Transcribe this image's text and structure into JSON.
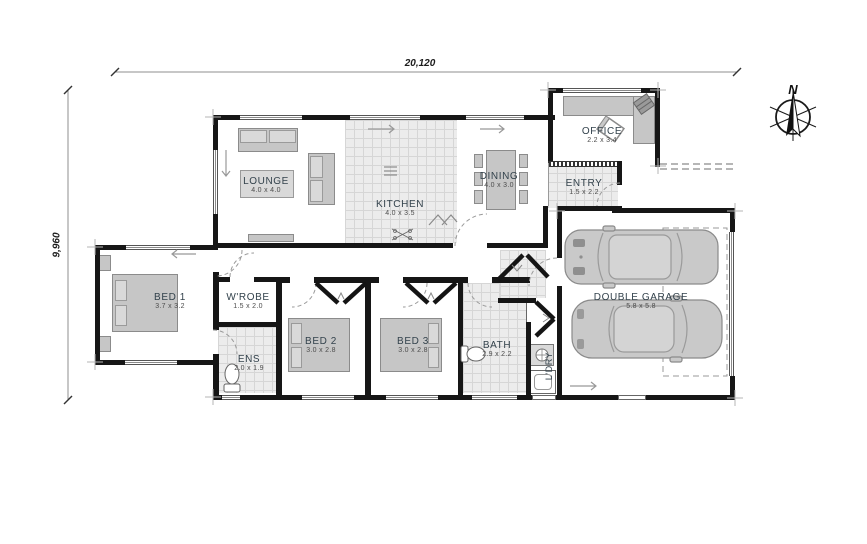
{
  "plan": {
    "dimensions": {
      "width_label": "20,120",
      "height_label": "9,960"
    },
    "compass": {
      "label": "N"
    },
    "rooms": [
      {
        "id": "lounge",
        "name": "LOUNGE",
        "dims": "4.0 x 4.0"
      },
      {
        "id": "kitchen",
        "name": "KITCHEN",
        "dims": "4.0 x 3.5"
      },
      {
        "id": "dining",
        "name": "DINING",
        "dims": "4.0 x 3.0"
      },
      {
        "id": "office",
        "name": "OFFICE",
        "dims": "2.2 x 3.4"
      },
      {
        "id": "entry",
        "name": "ENTRY",
        "dims": "1.5 x 2.2"
      },
      {
        "id": "bed1",
        "name": "BED 1",
        "dims": "3.7 x 3.2"
      },
      {
        "id": "wrobe",
        "name": "W'ROBE",
        "dims": "1.5 x 2.0"
      },
      {
        "id": "ens",
        "name": "ENS",
        "dims": "2.0 x 1.9"
      },
      {
        "id": "bed2",
        "name": "BED 2",
        "dims": "3.0 x 2.8"
      },
      {
        "id": "bed3",
        "name": "BED 3",
        "dims": "3.0 x 2.8"
      },
      {
        "id": "bath",
        "name": "BATH",
        "dims": "2.9 x 2.2"
      },
      {
        "id": "ldry",
        "name": "L'DRY",
        "dims": ""
      },
      {
        "id": "garage",
        "name": "DOUBLE GARAGE",
        "dims": "5.8 x 5.8"
      }
    ],
    "colors": {
      "wall": "#161616",
      "furniture": "#c6c6c6",
      "tile": "#ececec",
      "label": "#33424c",
      "dim_line": "#8f8f8f"
    }
  }
}
